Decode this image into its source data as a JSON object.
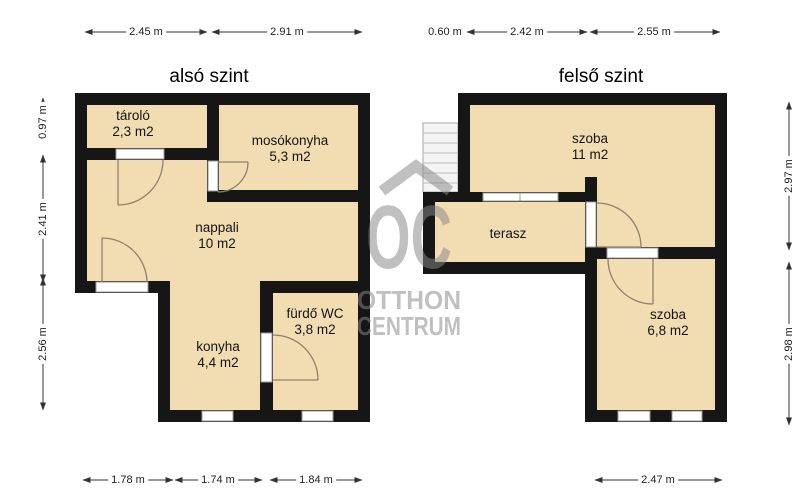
{
  "floors": {
    "lower": {
      "title": "alsó szint",
      "rooms": {
        "tarolo": {
          "name": "tároló",
          "area": "2,3 m2"
        },
        "mosokonyha": {
          "name": "mosókonyha",
          "area": "5,3 m2"
        },
        "nappali": {
          "name": "nappali",
          "area": "10 m2"
        },
        "konyha": {
          "name": "konyha",
          "area": "4,4 m2"
        },
        "furdo": {
          "name": "fürdő WC",
          "area": "3,8 m2"
        }
      }
    },
    "upper": {
      "title": "felső szint",
      "rooms": {
        "szoba1": {
          "name": "szoba",
          "area": "11 m2"
        },
        "terasz": {
          "name": "terasz"
        },
        "szoba2": {
          "name": "szoba",
          "area": "6,8 m2"
        }
      }
    }
  },
  "dimensions": {
    "top": [
      "2.45 m",
      "2.91 m",
      "0.60 m",
      "2.42 m",
      "2.55 m"
    ],
    "bottom": [
      "1.78 m",
      "1.74 m",
      "1.84 m",
      "2.47 m"
    ],
    "left": [
      "0.97 m",
      "2.41 m",
      "2.56 m"
    ],
    "right": [
      "2.97 m",
      "2.98 m"
    ]
  },
  "watermark": {
    "logo": "OC",
    "line1": "OTTHON",
    "line2": "CENTRUM"
  },
  "colors": {
    "floor": "#F2DDB3",
    "wall": "#161616",
    "watermark_gray": "#C4C4C4",
    "door_swing": "#8F8168"
  }
}
